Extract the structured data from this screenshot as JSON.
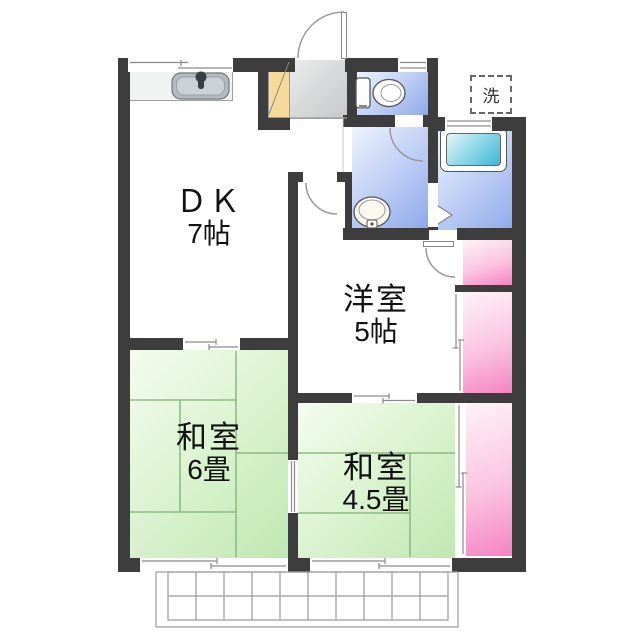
{
  "floor_plan": {
    "rooms": {
      "dk": {
        "name": "ＤＫ",
        "size": "7帖"
      },
      "western": {
        "name": "洋室",
        "size": "5帖"
      },
      "tatami6": {
        "name": "和室",
        "size": "6畳"
      },
      "tatami45": {
        "name": "和室",
        "size": "4.5畳"
      }
    },
    "laundry": {
      "label": "洗"
    },
    "fixtures": [
      "kitchen-sink",
      "toilet",
      "washbasin",
      "bathtub",
      "laundry-machine-space",
      "shoe-cabinet"
    ],
    "colors": {
      "wall": "#3d3d3d",
      "tatami_green": "#cdeec2",
      "closet_pink": "#f78fc6",
      "water_blue": "#93acea",
      "bathtub_cyan": "#3fb6d8",
      "genkan_gray": "#cfd1d3",
      "shoe_cabinet_tan": "#f7d99b"
    }
  }
}
